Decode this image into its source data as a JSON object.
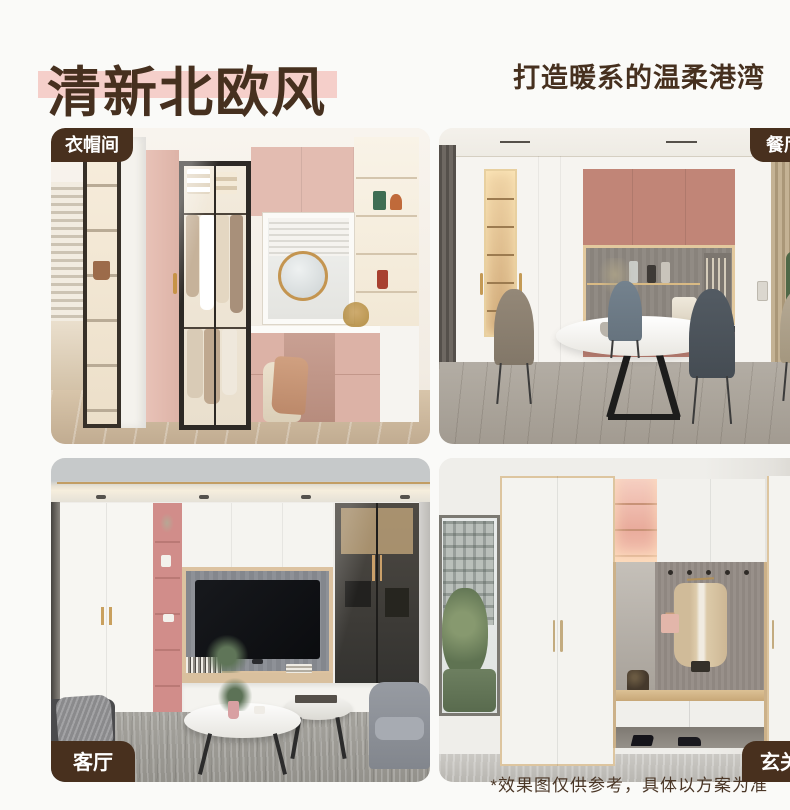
{
  "header": {
    "title": "清新北欧风",
    "subtitle": "打造暖系的温柔港湾",
    "title_color": "#46301f",
    "highlight_color": "#f5cfca"
  },
  "gallery": {
    "badge_bg": "#48301e",
    "badge_text_color": "#ffffff",
    "photos": [
      {
        "label": "衣帽间",
        "label_position": "top-left",
        "description": "L-shaped walk-in closet with glass-door wardrobe, pink panels, window vanity with round mirror and stool"
      },
      {
        "label": "餐厅",
        "label_position": "top-right",
        "description": "Dining room with white cabinet wall, dusty-pink upper cabinets, lighted display niche, round table and four chairs"
      },
      {
        "label": "客厅",
        "label_position": "bottom-left",
        "description": "Living room TV wall with white wardrobe, pink open shelves, wood-framed gray TV niche, glass cabinet, round coffee tables"
      },
      {
        "label": "玄关",
        "label_position": "bottom-right",
        "description": "Entry hallway cabinets with pink lighted shelves, coat hooks with hanging beige coat, bench, shoe drawers and window view"
      }
    ]
  },
  "footnote": {
    "text": "*效果图仅供参考，具体以方案为准",
    "color": "#4a3626"
  },
  "palette": {
    "page_background": "#fafaf8",
    "accent_pink_light": "#e6c0b5",
    "accent_pink_deep": "#c08577",
    "wood": "#d9bf9e"
  }
}
